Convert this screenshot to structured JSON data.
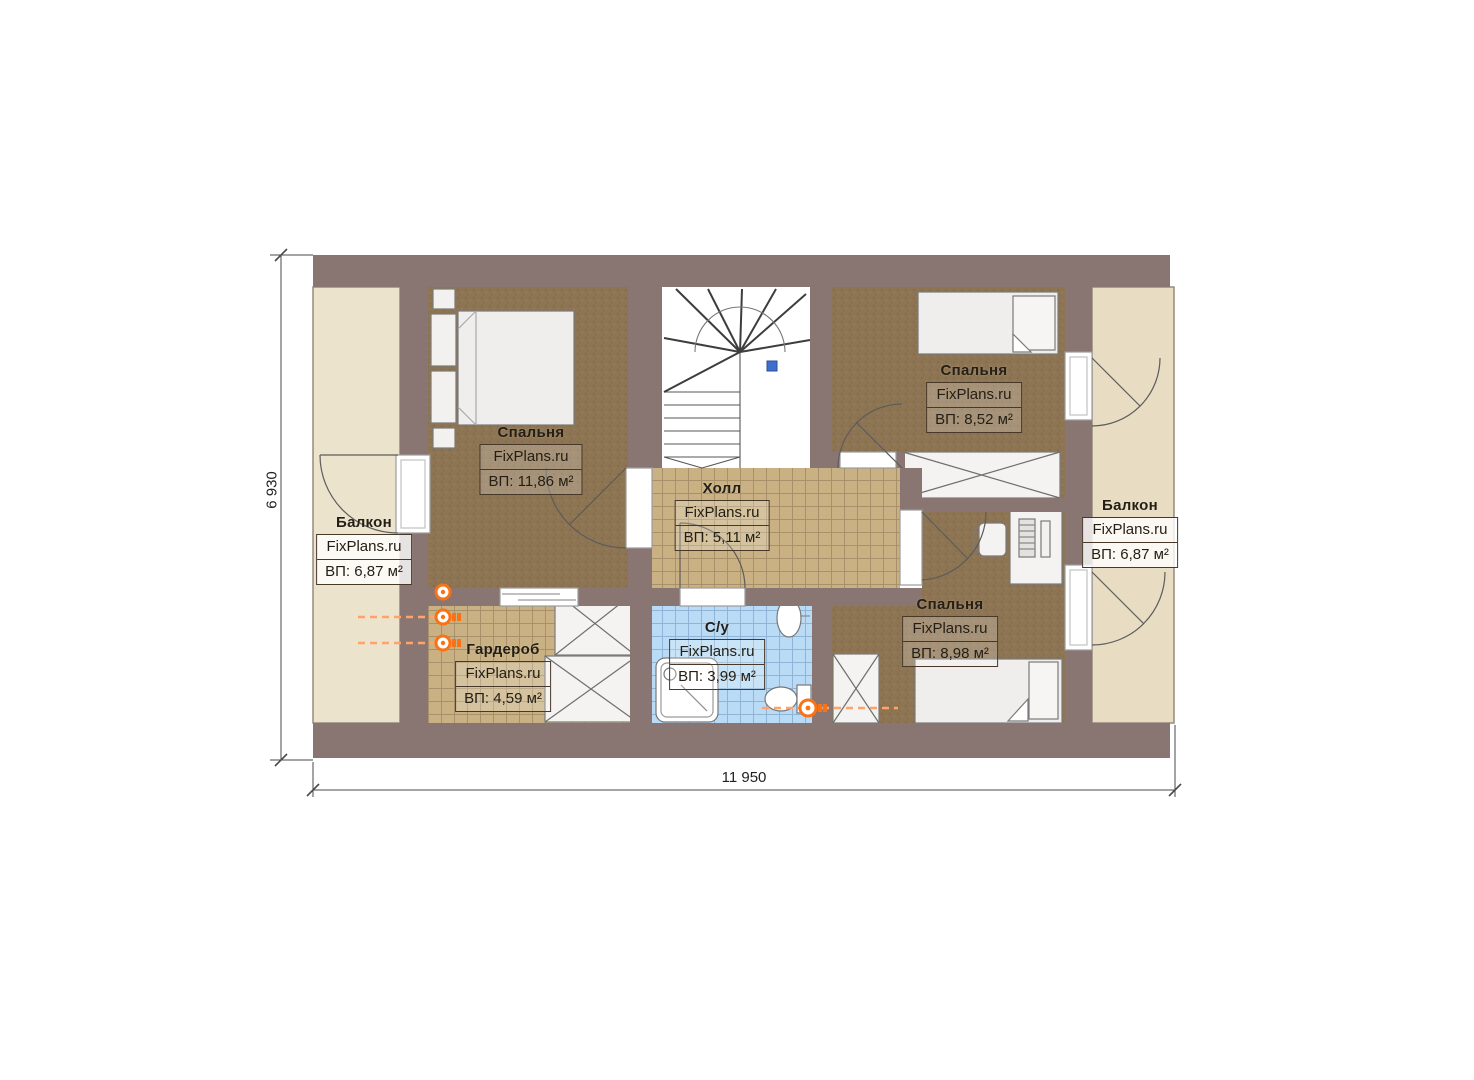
{
  "site": "FixPlans.ru",
  "rooms": {
    "bedroom_left": {
      "name": "Спальня",
      "watermark": "FixPlans.ru",
      "area": "ВП: 11,86 м²"
    },
    "hall": {
      "name": "Холл",
      "watermark": "FixPlans.ru",
      "area": "ВП: 5,11 м²"
    },
    "bedroom_top_right": {
      "name": "Спальня",
      "watermark": "FixPlans.ru",
      "area": "ВП: 8,52 м²"
    },
    "bedroom_bottom_right": {
      "name": "Спальня",
      "watermark": "FixPlans.ru",
      "area": "ВП: 8,98 м²"
    },
    "wardrobe": {
      "name": "Гардероб",
      "watermark": "FixPlans.ru",
      "area": "ВП: 4,59 м²"
    },
    "bathroom": {
      "name": "С/у",
      "watermark": "FixPlans.ru",
      "area": "ВП: 3,99 м²"
    },
    "balcony_left": {
      "name": "Балкон",
      "watermark": "FixPlans.ru",
      "area": "ВП: 6,87 м²"
    },
    "balcony_right": {
      "name": "Балкон",
      "watermark": "FixPlans.ru",
      "area": "ВП: 6,87 м²"
    }
  },
  "dimensions": {
    "overall_width": "11 950",
    "overall_height": "6 930"
  },
  "colors": {
    "wall": "#897672",
    "carpet": "#8d7452",
    "tile_tan": "#c9b183",
    "tile_blue": "#badbf5",
    "balcony": "#eae0c8",
    "marker_orange": "#f97316"
  }
}
